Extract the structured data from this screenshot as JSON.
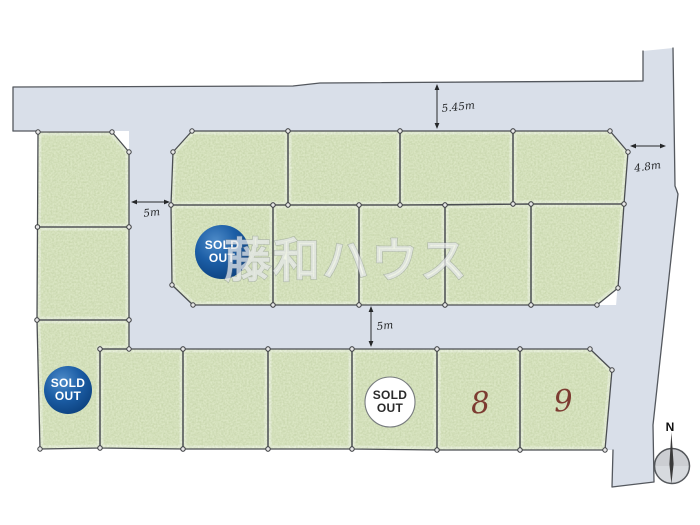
{
  "canvas": {
    "width": 700,
    "height": 525,
    "background": "#ffffff"
  },
  "watermark": {
    "text": "藤和ハウス",
    "x": 224,
    "y": 277,
    "font_size": 47,
    "fill": "rgba(255,255,255,0.62)",
    "stroke": "rgba(118,125,134,0.40)"
  },
  "colors": {
    "road_fill": "#d9dfe9",
    "road_edge": "#54585e",
    "lot_fill": "#e3edcd",
    "lot_edge": "#4b4e52",
    "lot_inner_glow": "#f2f7e8",
    "dim_color": "#26282a",
    "number_color": "#7c3b31",
    "badge_blue_light": "#4e8bc8",
    "badge_blue_dark": "#083a75"
  },
  "roads": {
    "polys": [
      "13,87 293,86 320,83 643,81 643,131 13,131",
      "129,131 193,131 193,306 129,306",
      "129,305 620,305 620,350 129,350",
      "643,131 643,51 673,48 675,186 678,194 653,425 654,482 612,487 613,450 604,450 611,371 589,351 589,306 616,306 628,152 610,131"
    ],
    "edge_paths": [
      "M13,131 L13,87 L293,86 L320,83 L643,81 L643,51",
      "M673,48 L675,186 L678,194 L653,425 L654,482 L612,487 L613,450",
      "M13,131 L39,131"
    ]
  },
  "lots": [
    {
      "points": "38,132 112,132 129,152 129,227 37.5,227"
    },
    {
      "points": "37.5,227 129,227 129,320 37,320"
    },
    {
      "points": "37,320 129,320 129,349 100,349 100,448 40,449",
      "badge": {
        "style": "blue",
        "cx": 68,
        "cy": 390,
        "r": 24,
        "lines": [
          "SOLD",
          "OUT"
        ]
      }
    },
    {
      "points": "192,131 288,131 288,205 171,205 173,152"
    },
    {
      "points": "288,131 400,131 400,205 288,205"
    },
    {
      "points": "400,131 513,131 513,204 400,205"
    },
    {
      "points": "513,131 610,131 628,152 624,204 513,204"
    },
    {
      "points": "171,205 273,205 273,305 193,305 172,285",
      "badge": {
        "style": "blue",
        "cx": 222,
        "cy": 252,
        "r": 27,
        "lines": [
          "SOLD",
          "OUT"
        ]
      }
    },
    {
      "points": "273,205 359,205 359,305 273,305"
    },
    {
      "points": "359,205 445,205 445,305 359,305"
    },
    {
      "points": "445,205 531,204 531,305 445,305"
    },
    {
      "points": "531,204 624,204 618,288 597,305 531,305"
    },
    {
      "points": "100,349 183,349 183,449 100,448"
    },
    {
      "points": "183,349 268,349 268,449 183,449"
    },
    {
      "points": "268,349 352,349 352,449 268,449"
    },
    {
      "points": "352,349 437,349 437,450 352,449",
      "badge": {
        "style": "white",
        "cx": 390,
        "cy": 402,
        "r": 25,
        "lines": [
          "SOLD",
          "OUT"
        ]
      }
    },
    {
      "points": "437,349 520,349 520,450 437,450",
      "number": {
        "text": "8",
        "x": 481,
        "y": 413
      }
    },
    {
      "points": "520,349 590,349 612,370 605,450 520,450",
      "number": {
        "text": "9",
        "x": 564,
        "y": 411
      }
    }
  ],
  "dimensions": [
    {
      "label": "5.45m",
      "orient": "v",
      "x": 437,
      "y1": 84,
      "y2": 129,
      "lx": 442,
      "ly": 112,
      "anchor": "start",
      "rot": -6
    },
    {
      "label": "4.8m",
      "orient": "h",
      "y": 146,
      "x1": 630,
      "x2": 666,
      "lx": 648,
      "ly": 170,
      "anchor": "middle",
      "rot": -8
    },
    {
      "label": "5m",
      "orient": "h",
      "y": 202,
      "x1": 131,
      "x2": 170,
      "lx": 152,
      "ly": 216,
      "anchor": "middle",
      "rot": -6
    },
    {
      "label": "5m",
      "orient": "v",
      "x": 371,
      "y1": 306,
      "y2": 347,
      "lx": 377,
      "ly": 330,
      "anchor": "start",
      "rot": -6
    }
  ],
  "compass": {
    "label": "N",
    "cx": 672,
    "cy": 466,
    "r": 17.5,
    "nx": 670,
    "ny": 431
  }
}
